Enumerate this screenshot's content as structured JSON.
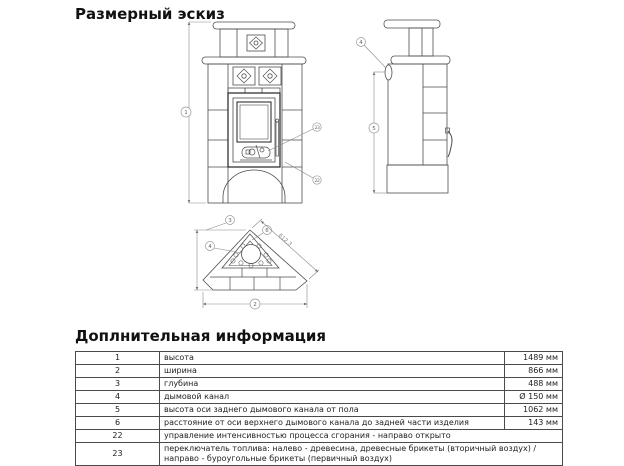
{
  "page": {
    "sketch_title": "Размерный эскиз",
    "info_title": "Доплнительная информация"
  },
  "drawing": {
    "labels": {
      "height_no": "1",
      "width_no": "2",
      "depth_no": "3",
      "smoke_channel_no": "4",
      "rear_channel_height_no": "5",
      "top_channel_distance_no": "6",
      "intensity_control_no": "22",
      "fuel_switch_no": "23",
      "diagonal_dim": "612,3"
    }
  },
  "info_table": {
    "rows": [
      {
        "num": "1",
        "desc": "высота",
        "value": "1489 мм"
      },
      {
        "num": "2",
        "desc": "ширина",
        "value": "866 мм"
      },
      {
        "num": "3",
        "desc": "глубина",
        "value": "488 мм"
      },
      {
        "num": "4",
        "desc": "дымовой канал",
        "value": "Ø 150 мм"
      },
      {
        "num": "5",
        "desc": "высота оси заднего дымового канала от пола",
        "value": "1062 мм"
      },
      {
        "num": "6",
        "desc": "расстояние от оси верхнего дымового канала до задней части изделия",
        "value": "143 мм"
      },
      {
        "num": "22",
        "desc": "управление интенсивностью процесса сгорания - направо открыто",
        "value": ""
      },
      {
        "num": "23",
        "desc": "переключатель топлива: налево - древесина, древесные брикеты (вторичный воздух) / направо - буроугольные брикеты (первичный воздух)",
        "value": ""
      }
    ]
  }
}
